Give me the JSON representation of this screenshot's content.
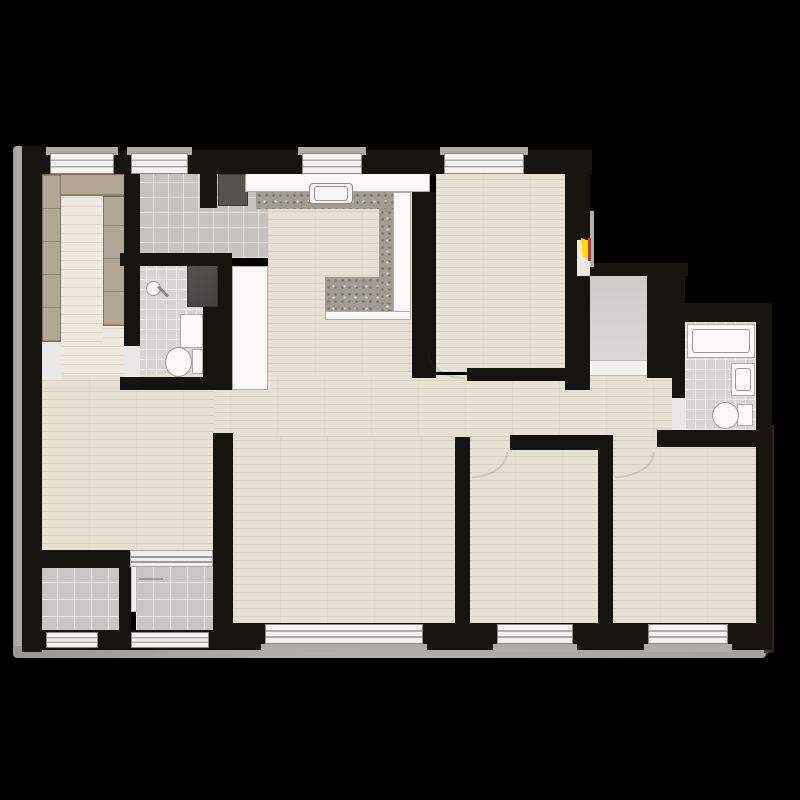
{
  "scene": {
    "width": 800,
    "height": 800,
    "background": "#000000",
    "description": "apartment-floor-plan"
  },
  "palette": {
    "background": "#000000",
    "wall": "#16140f",
    "wood_floor": "#e7e1d5",
    "wardrobe_tan": "#b2a695",
    "tile_gray": "#c9c7c3",
    "granite_counter": "#a29d93",
    "fixture_white": "#fbfaf8",
    "fixture_dark": "#504e49",
    "doormat_dark": "#56544e",
    "window_frame": "#f4f3f1",
    "door_marker_yellow": "#ffdf00",
    "door_marker_red": "#d03325",
    "outer_border_gray": "#b3b0ab"
  },
  "plan": {
    "items": [
      {
        "n": "outer-border-left",
        "t": "outer",
        "b": [
          13,
          146,
          12,
          510
        ]
      },
      {
        "n": "outer-border-bottom",
        "t": "outer",
        "b": [
          13,
          646,
          753,
          12
        ]
      },
      {
        "n": "outer-border-right",
        "t": "outerdark",
        "b": [
          764,
          425,
          10,
          228
        ]
      },
      {
        "n": "closet-room-floor",
        "t": "wood2",
        "b": [
          42,
          170,
          84,
          222
        ]
      },
      {
        "n": "foyer-tile-floor",
        "t": "tilef",
        "b": [
          138,
          170,
          130,
          88
        ]
      },
      {
        "n": "bathroom-left-floor",
        "t": "baths",
        "b": [
          136,
          258,
          68,
          122
        ]
      },
      {
        "n": "kitchen-floor",
        "t": "wood",
        "b": [
          268,
          192,
          144,
          188
        ]
      },
      {
        "n": "bedroom-top-floor",
        "t": "wood",
        "b": [
          436,
          170,
          130,
          202
        ]
      },
      {
        "n": "hallway-floor",
        "t": "wood",
        "b": [
          42,
          375,
          641,
          62
        ]
      },
      {
        "n": "living-room-floor",
        "t": "wood",
        "b": [
          42,
          390,
          172,
          162
        ]
      },
      {
        "n": "bedroom-left-floor",
        "t": "wood",
        "b": [
          233,
          437,
          222,
          188
        ]
      },
      {
        "n": "bedroom-middle-floor",
        "t": "wood",
        "b": [
          468,
          437,
          130,
          188
        ]
      },
      {
        "n": "bedroom-right-floor",
        "t": "wood",
        "b": [
          613,
          437,
          144,
          188
        ]
      },
      {
        "n": "vestibule-tile-floor",
        "t": "vest",
        "b": [
          588,
          275,
          60,
          86
        ]
      },
      {
        "n": "entry-threshold",
        "t": "thr",
        "b": [
          586,
          360,
          64,
          16
        ]
      },
      {
        "n": "bathroom-right-floor",
        "t": "baths",
        "b": [
          685,
          322,
          72,
          108
        ]
      },
      {
        "n": "balcony-left-floor",
        "t": "tilem",
        "b": [
          40,
          566,
          80,
          68
        ]
      },
      {
        "n": "balcony-right-floor",
        "t": "tilem",
        "b": [
          136,
          566,
          77,
          68
        ]
      },
      {
        "n": "closet-corner-tile",
        "t": "gap",
        "b": [
          42,
          342,
          20,
          38
        ]
      },
      {
        "n": "wardrobe-top",
        "t": "tan",
        "b": [
          42,
          174,
          84,
          22
        ]
      },
      {
        "n": "wardrobe-left",
        "t": "tan",
        "b": [
          42,
          174,
          19,
          168
        ]
      },
      {
        "n": "wardrobe-right",
        "t": "tan",
        "b": [
          103,
          196,
          23,
          130
        ]
      },
      {
        "n": "closet-runner-rug",
        "t": "wood2",
        "b": [
          61,
          196,
          42,
          146
        ]
      },
      {
        "n": "entry-doormat",
        "t": "mat",
        "b": [
          218,
          174,
          30,
          32
        ]
      },
      {
        "n": "refrigerator",
        "t": "whitefix",
        "b": [
          232,
          266,
          36,
          124
        ]
      },
      {
        "n": "washing-machine",
        "t": "darkfix",
        "b": [
          187,
          263,
          31,
          44
        ]
      },
      {
        "n": "kitchen-counter-top",
        "t": "whitefix",
        "b": [
          245,
          172,
          185,
          20
        ]
      },
      {
        "n": "kitchen-counter-granite-top",
        "t": "granite",
        "b": [
          256,
          192,
          137,
          17
        ]
      },
      {
        "n": "kitchen-counter-granite-right",
        "t": "granite",
        "b": [
          379,
          209,
          14,
          102
        ]
      },
      {
        "n": "kitchen-island-granite",
        "t": "granite",
        "b": [
          325,
          277,
          54,
          34
        ]
      },
      {
        "n": "kitchen-counter-white-right",
        "t": "whitefix",
        "b": [
          393,
          192,
          18,
          121
        ]
      },
      {
        "n": "kitchen-counter-white-bottom",
        "t": "whitefix",
        "b": [
          325,
          311,
          86,
          9
        ]
      },
      {
        "n": "kitchen-sink",
        "t": "sink",
        "b": [
          309,
          183,
          44,
          21
        ]
      },
      {
        "n": "kitchen-sink-basin",
        "t": "basin",
        "b": [
          314,
          186,
          34,
          15
        ]
      },
      {
        "n": "shower-head",
        "t": "ovalwhite",
        "b": [
          146,
          281,
          15,
          15
        ]
      },
      {
        "n": "shower-arm",
        "t": "rot45",
        "b": [
          156,
          290,
          14,
          3
        ]
      },
      {
        "n": "bathroom-left-sink",
        "t": "whitefix",
        "b": [
          180,
          314,
          23,
          34
        ]
      },
      {
        "n": "bathroom-left-toilet-tank",
        "t": "whitefix",
        "b": [
          192,
          349,
          11,
          25
        ]
      },
      {
        "n": "bathroom-left-toilet-bowl",
        "t": "ovalwhite",
        "b": [
          165,
          347,
          27,
          30
        ]
      },
      {
        "n": "bathtub",
        "t": "whitefix",
        "b": [
          687,
          324,
          68,
          34
        ]
      },
      {
        "n": "bathtub-inner",
        "t": "basin",
        "b": [
          692,
          329,
          58,
          24
        ]
      },
      {
        "n": "bathroom-right-sink",
        "t": "whitefix",
        "b": [
          731,
          363,
          24,
          33
        ]
      },
      {
        "n": "bathroom-right-sink-basin",
        "t": "basin",
        "b": [
          735,
          368,
          16,
          23
        ]
      },
      {
        "n": "bathroom-right-toilet-tank",
        "t": "whitefix",
        "b": [
          737,
          404,
          16,
          22
        ]
      },
      {
        "n": "bathroom-right-toilet-bowl",
        "t": "ovalwhite",
        "b": [
          712,
          402,
          27,
          27
        ]
      },
      {
        "n": "wall-exterior-left",
        "t": "wall",
        "b": [
          22,
          146,
          20,
          506
        ]
      },
      {
        "n": "wall-exterior-top",
        "t": "wall",
        "b": [
          22,
          150,
          570,
          24
        ]
      },
      {
        "n": "wall-exterior-bottom-left",
        "t": "wall",
        "b": [
          22,
          630,
          193,
          20
        ]
      },
      {
        "n": "wall-exterior-bottom",
        "t": "wall",
        "b": [
          215,
          623,
          551,
          27
        ]
      },
      {
        "n": "wall-exterior-right",
        "t": "wall",
        "b": [
          756,
          303,
          16,
          347
        ]
      },
      {
        "n": "wall-closet-foyer",
        "t": "wall",
        "b": [
          124,
          150,
          16,
          196
        ]
      },
      {
        "n": "wall-foyer-stub",
        "t": "wall",
        "b": [
          200,
          172,
          17,
          36
        ]
      },
      {
        "n": "wall-foyer-bathroom",
        "t": "wall",
        "b": [
          120,
          253,
          112,
          13
        ]
      },
      {
        "n": "wall-bathroom-duct",
        "t": "wall",
        "b": [
          218,
          266,
          14,
          124
        ]
      },
      {
        "n": "wall-bathroom-inner",
        "t": "wall",
        "b": [
          203,
          307,
          15,
          83
        ]
      },
      {
        "n": "wall-bathroom-bottom",
        "t": "wall",
        "b": [
          120,
          377,
          98,
          13
        ]
      },
      {
        "n": "wall-kitchen-right",
        "t": "wall",
        "b": [
          412,
          192,
          24,
          186
        ]
      },
      {
        "n": "wall-bedroom-top-bottom",
        "t": "wall",
        "b": [
          467,
          368,
          98,
          13
        ]
      },
      {
        "n": "wall-entry-column",
        "t": "wall",
        "b": [
          565,
          150,
          25,
          240
        ]
      },
      {
        "n": "wall-vestibule-top",
        "t": "wall",
        "b": [
          565,
          263,
          123,
          13
        ]
      },
      {
        "n": "wall-vestibule-right",
        "t": "wall",
        "b": [
          647,
          276,
          25,
          102
        ]
      },
      {
        "n": "wall-bathroom-right-left",
        "t": "wall",
        "b": [
          672,
          276,
          13,
          122
        ]
      },
      {
        "n": "wall-bathroom-right-top",
        "t": "wall",
        "b": [
          670,
          303,
          88,
          19
        ]
      },
      {
        "n": "wall-bathroom-right-bottom",
        "t": "wall",
        "b": [
          657,
          430,
          100,
          17
        ]
      },
      {
        "n": "wall-living-balcony",
        "t": "wall",
        "b": [
          22,
          550,
          108,
          18
        ]
      },
      {
        "n": "wall-balcony-divider",
        "t": "wall",
        "b": [
          119,
          566,
          12,
          84
        ]
      },
      {
        "n": "wall-living-bedrooms",
        "t": "wall",
        "b": [
          213,
          433,
          20,
          217
        ]
      },
      {
        "n": "wall-bedrooms-middle-divider",
        "t": "wall",
        "b": [
          455,
          437,
          15,
          193
        ]
      },
      {
        "n": "wall-bedroom-middle-top",
        "t": "wall",
        "b": [
          510,
          435,
          103,
          15
        ]
      },
      {
        "n": "wall-bedroom-right-left",
        "t": "wall",
        "b": [
          598,
          435,
          15,
          195
        ]
      },
      {
        "n": "bathroom-left-door-gap",
        "t": "gap",
        "b": [
          124,
          346,
          16,
          31
        ]
      },
      {
        "n": "entry-door-gap",
        "t": "gap",
        "b": [
          577,
          240,
          13,
          36
        ]
      },
      {
        "n": "bathroom-right-door-gap",
        "t": "gap",
        "b": [
          672,
          398,
          13,
          32
        ]
      },
      {
        "n": "balcony-divider-door",
        "t": "thr",
        "b": [
          131,
          566,
          6,
          46
        ]
      },
      {
        "n": "living-balcony-slider",
        "t": "slider",
        "b": [
          130,
          550,
          83,
          17
        ]
      },
      {
        "n": "window-sill-1",
        "t": "sill",
        "b": [
          46,
          147,
          72,
          8
        ]
      },
      {
        "n": "window-top-1",
        "t": "win",
        "b": [
          50,
          153,
          64,
          21
        ]
      },
      {
        "n": "window-sill-2",
        "t": "sill",
        "b": [
          127,
          147,
          65,
          8
        ]
      },
      {
        "n": "window-top-2",
        "t": "win",
        "b": [
          131,
          153,
          57,
          21
        ]
      },
      {
        "n": "window-sill-3",
        "t": "sill",
        "b": [
          298,
          147,
          68,
          8
        ]
      },
      {
        "n": "window-top-3",
        "t": "win",
        "b": [
          302,
          153,
          60,
          21
        ]
      },
      {
        "n": "window-sill-4",
        "t": "sill",
        "b": [
          440,
          147,
          88,
          8
        ]
      },
      {
        "n": "window-top-4",
        "t": "win",
        "b": [
          444,
          153,
          80,
          21
        ]
      },
      {
        "n": "window-bottom-sill-1",
        "t": "sill",
        "b": [
          261,
          644,
          166,
          8
        ]
      },
      {
        "n": "window-bottom-1",
        "t": "win",
        "b": [
          265,
          624,
          158,
          20
        ]
      },
      {
        "n": "window-bottom-sill-2",
        "t": "sill",
        "b": [
          493,
          644,
          84,
          8
        ]
      },
      {
        "n": "window-bottom-2",
        "t": "win",
        "b": [
          497,
          624,
          76,
          20
        ]
      },
      {
        "n": "window-bottom-sill-3",
        "t": "sill",
        "b": [
          644,
          644,
          88,
          8
        ]
      },
      {
        "n": "window-bottom-3",
        "t": "win",
        "b": [
          648,
          624,
          80,
          20
        ]
      },
      {
        "n": "window-balcony-left",
        "t": "win",
        "b": [
          46,
          632,
          52,
          16
        ]
      },
      {
        "n": "window-balcony-right",
        "t": "win",
        "b": [
          131,
          632,
          78,
          16
        ]
      },
      {
        "n": "entry-door-leaf",
        "t": "leaf",
        "b": [
          590,
          211,
          4,
          56
        ]
      },
      {
        "n": "entry-door-marker-yellow",
        "t": "accy",
        "b": [
          581,
          238,
          9,
          21
        ]
      },
      {
        "n": "entry-door-marker-red",
        "t": "accr",
        "b": [
          588,
          238,
          3,
          23
        ]
      },
      {
        "n": "door-arc-bedroom-top",
        "t": "arcbl",
        "b": [
          427,
          352,
          38,
          27
        ]
      },
      {
        "n": "door-arc-bedroom-middle",
        "t": "arcbr",
        "b": [
          472,
          452,
          36,
          26
        ]
      },
      {
        "n": "door-arc-bedroom-right",
        "t": "arcbr",
        "b": [
          615,
          452,
          40,
          26
        ]
      },
      {
        "n": "balcony-door-swing-line",
        "t": "thinline",
        "b": [
          139,
          578,
          24,
          2
        ]
      }
    ]
  }
}
